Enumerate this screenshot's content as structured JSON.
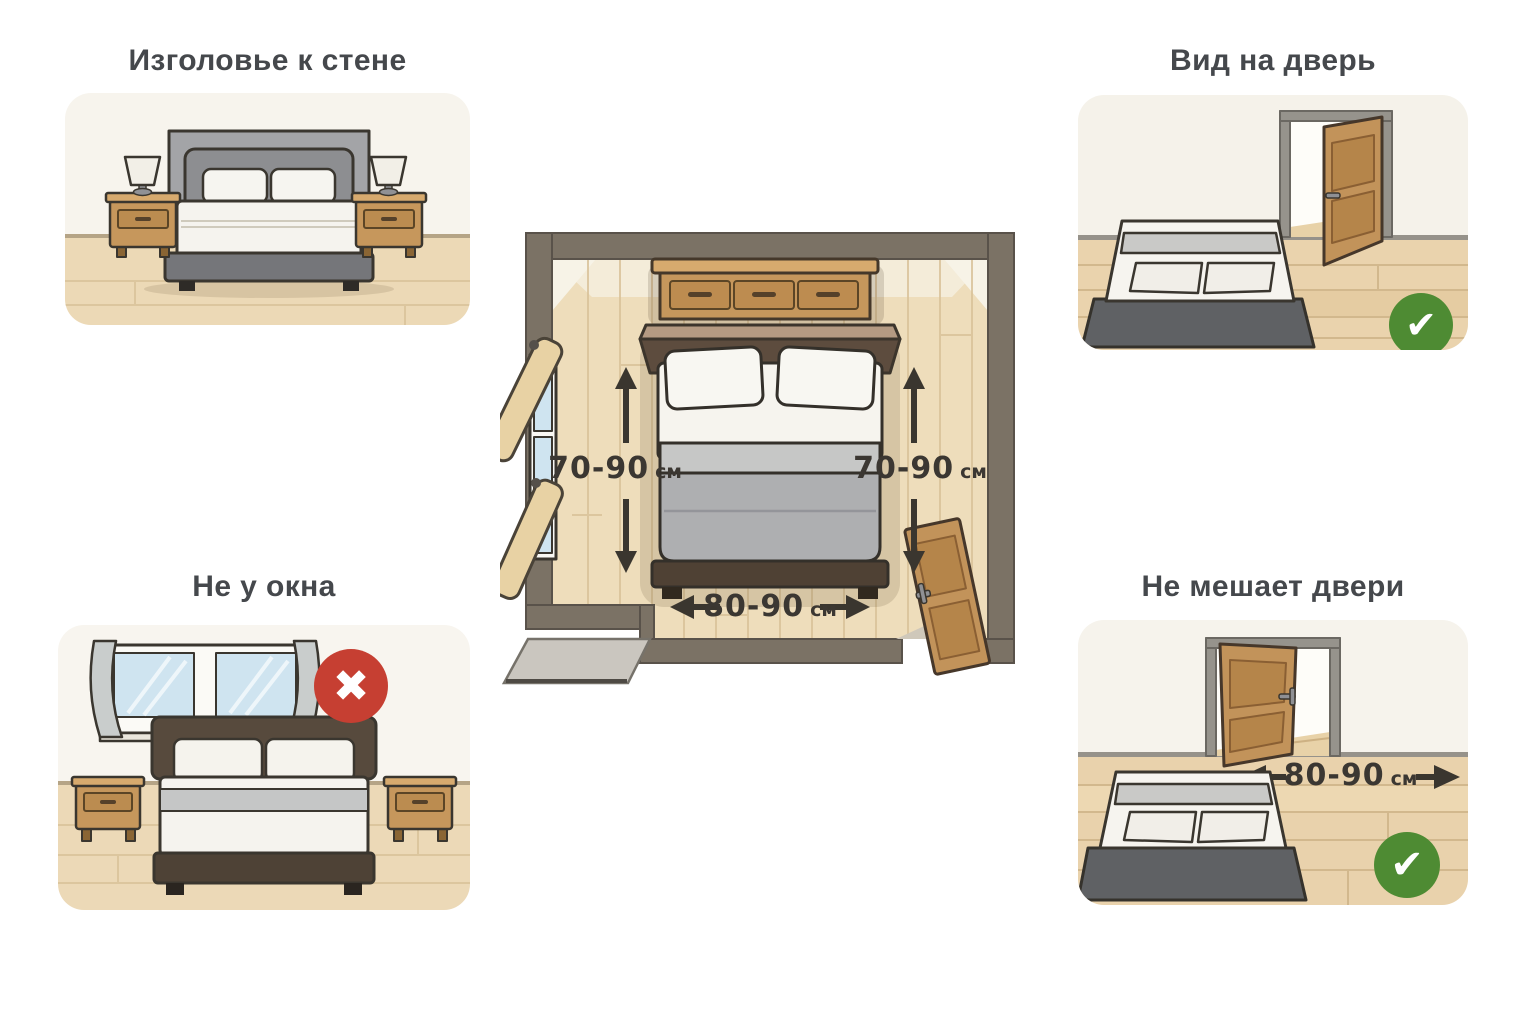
{
  "panels": {
    "top_left": {
      "title": "Изголовье к стене"
    },
    "top_right": {
      "title": "Вид на дверь"
    },
    "bottom_left": {
      "title": "Не у окна"
    },
    "bottom_right": {
      "title": "Не мешает двери",
      "measurement": {
        "value": "80-90",
        "unit": "см"
      }
    }
  },
  "floor_plan": {
    "left_clearance": {
      "value": "70-90",
      "unit": "см"
    },
    "right_clearance": {
      "value": "70-90",
      "unit": "см"
    },
    "bottom_clearance": {
      "value": "80-90",
      "unit": "см"
    }
  },
  "icons": {
    "check": "✔",
    "cross": "✖"
  },
  "colors": {
    "check_bg": "#4e8b33",
    "cross_bg": "#c63f32",
    "measure_text": "#3b3732",
    "title_text": "#45484c",
    "wall": "#7b7265",
    "floor": "#eeddbb",
    "wood": "#c6975c",
    "door_wood": "#c2935a"
  }
}
